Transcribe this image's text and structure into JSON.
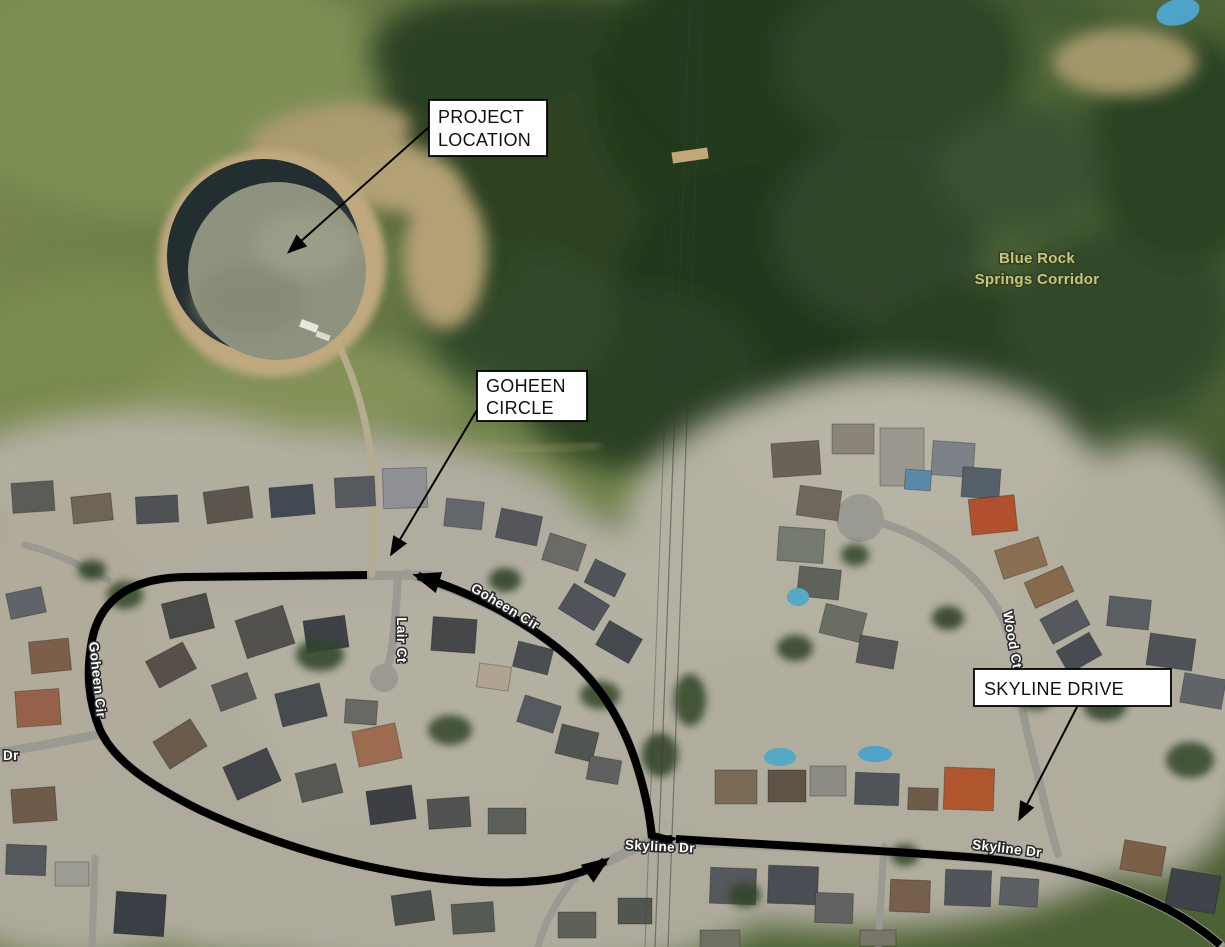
{
  "callouts": {
    "project_location": {
      "line1": "PROJECT",
      "line2": "LOCATION"
    },
    "goheen_circle": {
      "line1": "GOHEEN",
      "line2": "CIRCLE"
    },
    "skyline_drive": {
      "label": "SKYLINE DRIVE"
    }
  },
  "map_labels": {
    "area": {
      "line1": "Blue Rock",
      "line2": "Springs Corridor"
    },
    "streets": {
      "goheen_cir_west": "Goheen Cir",
      "goheen_cir_east": "Goheen Cir",
      "lair_ct": "Lair Ct",
      "wood_ct": "Wood Ct",
      "skyline_dr_west": "Skyline Dr",
      "skyline_dr_east": "Skyline Dr",
      "edge_dr": "Dr"
    }
  },
  "colors": {
    "route": "#000000",
    "callout_bg": "#ffffff",
    "callout_border": "#000000",
    "area_label_fill": "#c3c67c",
    "street_label_fill": "#ffffff"
  }
}
